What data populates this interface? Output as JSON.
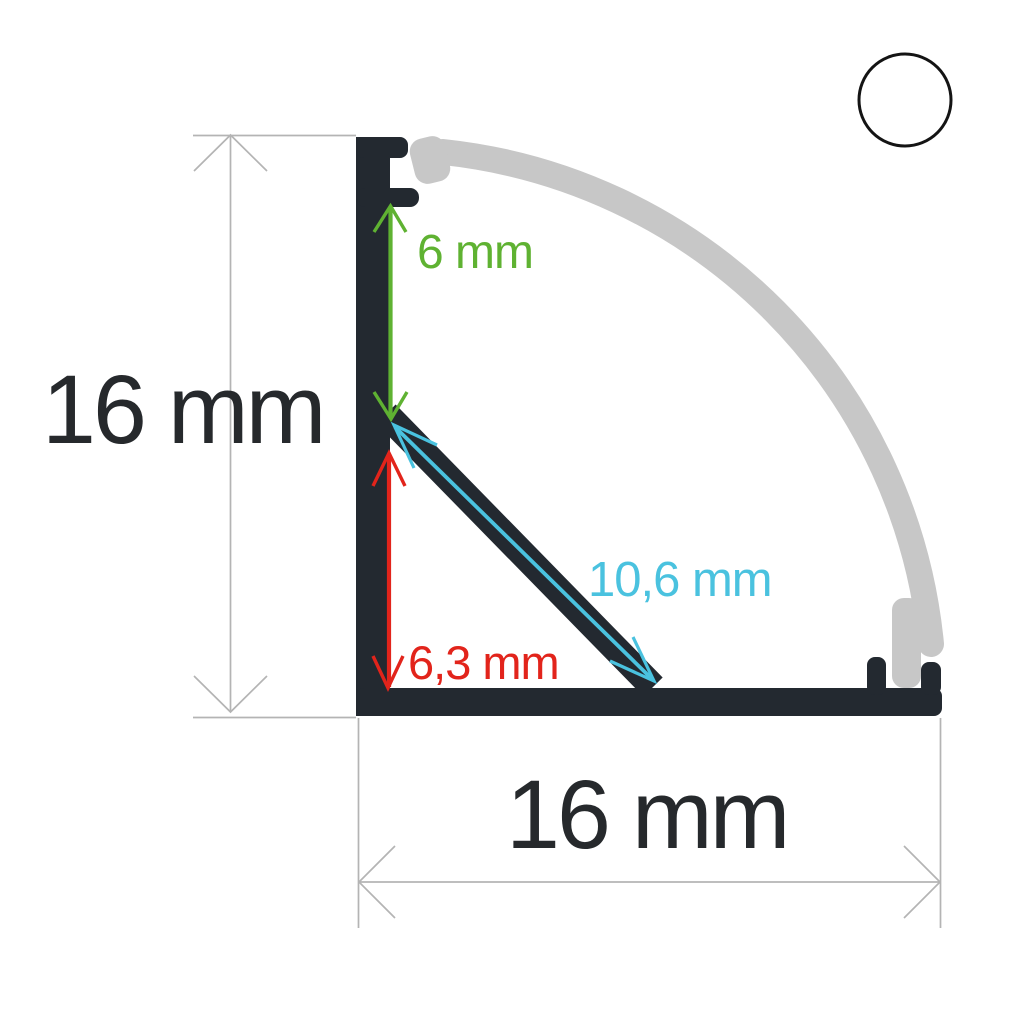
{
  "diagram": {
    "kind": "corner-led-profile-cross-section",
    "background_color": "#ffffff",
    "profile_color": "#232930",
    "diffuser_color": "#c7c7c7",
    "dimension_line_color": "#b4b4b4",
    "badge": {
      "fill": "#ffffff",
      "stroke": "#141414"
    }
  },
  "labels": {
    "total_height": {
      "text": "16 mm",
      "color": "#26292c"
    },
    "total_width": {
      "text": "16 mm",
      "color": "#26292c"
    },
    "top_depth": {
      "text": "6 mm",
      "color": "#5fb232"
    },
    "bottom_depth": {
      "text": "6,3 mm",
      "color": "#e2241b"
    },
    "diagonal": {
      "text": "10,6 mm",
      "color": "#4ac2df"
    }
  }
}
